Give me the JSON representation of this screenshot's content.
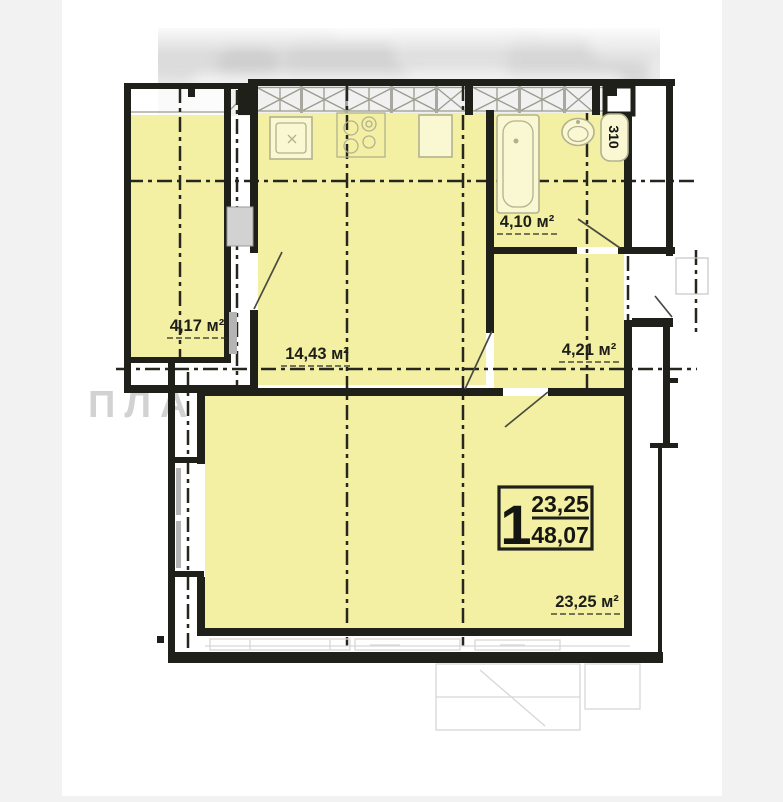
{
  "watermark": {
    "text": "ПЛАНУВА"
  },
  "floorplan": {
    "rooms": {
      "loggia": {
        "area": "4,17 м²"
      },
      "kitchen": {
        "area": "14,43 м²"
      },
      "bathroom": {
        "area": "4,10 м²"
      },
      "hallway": {
        "area": "4,21 м²"
      },
      "living": {
        "area": "23,25 м²"
      }
    },
    "unit_box": {
      "rooms_count": "1",
      "living_area": "23,25",
      "total_area": "48,07"
    },
    "duct_label": "310"
  },
  "colors": {
    "room_fill": "#f3f0a3",
    "wall": "#20201b",
    "axis": "#26261f",
    "fixture": "#b2b290",
    "watermark": "#d2d2d2",
    "margin": "#f2f2f3",
    "faint": "#d7d7d7"
  }
}
